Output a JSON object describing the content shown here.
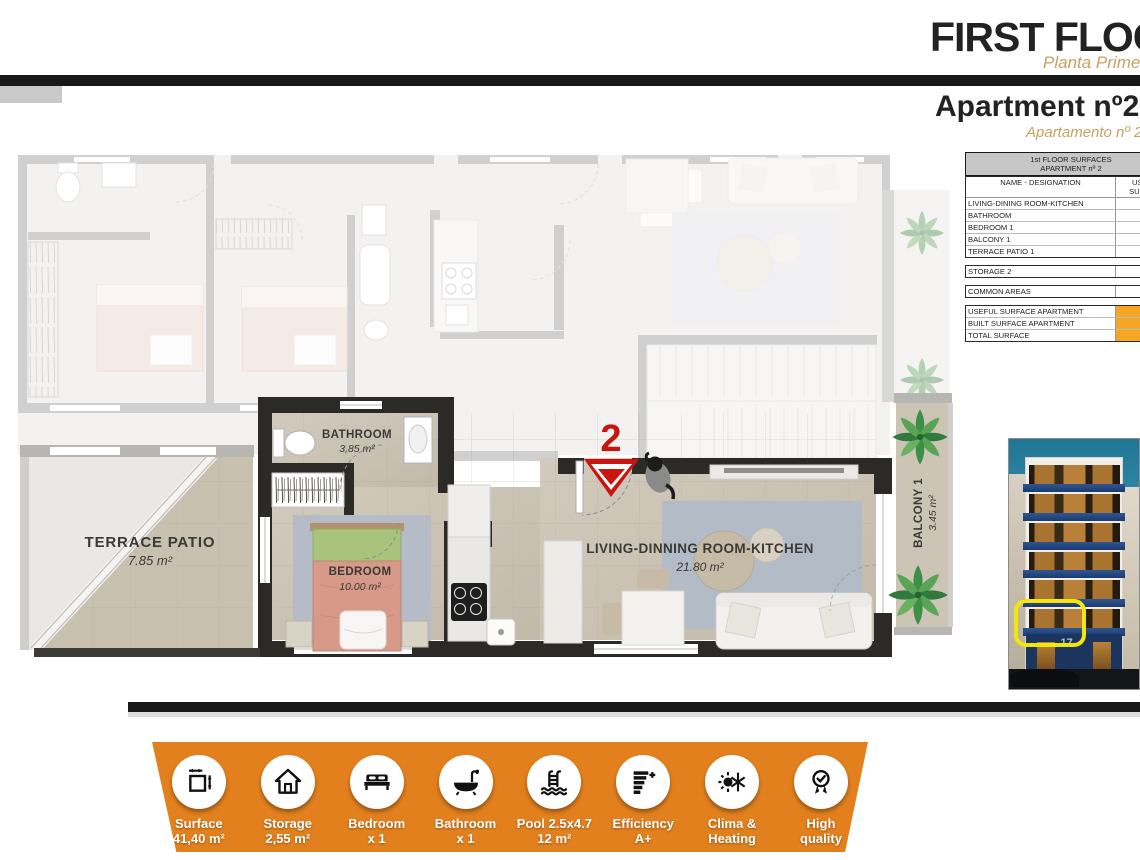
{
  "header": {
    "title": "FIRST FLOOR",
    "subtitle": "Planta Primera",
    "apartment_title": "Apartment nº2",
    "apartment_subtitle": "Apartamento nº 2"
  },
  "surfaces_table": {
    "title_line1": "1st FLOOR SURFACES",
    "title_line2": "APARTMENT nº 2",
    "col_name": "NAME - DESIGNATION",
    "col_value": "USEFUL SURFACE",
    "rooms": [
      {
        "name": "LIVING-DINING ROOM-KITCHEN",
        "value": "21.79 m²"
      },
      {
        "name": "BATHROOM",
        "value": "3.86 m²"
      },
      {
        "name": "BEDROOM 1",
        "value": "9.61 m²"
      },
      {
        "name": "BALCONY 1",
        "value": "3.45 m²"
      },
      {
        "name": "TERRACE PATIO 1",
        "value": "7.82 m²"
      }
    ],
    "storage": {
      "name": "STORAGE 2",
      "value": "2.55 m²"
    },
    "common_areas": {
      "name": "COMMON AREAS",
      "value": "6.95 m²"
    },
    "totals": [
      {
        "name": "USEFUL SURFACE APARTMENT",
        "value": "35.26 m²"
      },
      {
        "name": "BUILT SURFACE APARTMENT",
        "value": "41.37 m²"
      },
      {
        "name": "TOTAL SURFACE",
        "value": "62.14 m²"
      }
    ]
  },
  "floor_plan": {
    "entrance_number": "2",
    "rooms": {
      "terrace": {
        "name": "TERRACE  PATIO",
        "area": "7.85 m²"
      },
      "bathroom": {
        "name": "BATHROOM",
        "area": "3,85 m²"
      },
      "bedroom": {
        "name": "BEDROOM",
        "area": "10.00 m²"
      },
      "living": {
        "name": "LIVING-DINNING ROOM-KITCHEN",
        "area": "21.80 m²"
      },
      "balcony": {
        "name": "BALCONY 1",
        "area": "3.45 m²"
      }
    }
  },
  "building_photo": {
    "street_number": "17"
  },
  "footer": {
    "items": [
      {
        "icon": "surface-icon",
        "line1": "Surface",
        "line2": "41,40 m²"
      },
      {
        "icon": "storage-icon",
        "line1": "Storage",
        "line2": "2,55 m²"
      },
      {
        "icon": "bed-icon",
        "line1": "Bedroom",
        "line2": "x 1"
      },
      {
        "icon": "bath-icon",
        "line1": "Bathroom",
        "line2": "x 1"
      },
      {
        "icon": "pool-icon",
        "line1": "Pool 2.5x4.7",
        "line2": "12 m²"
      },
      {
        "icon": "efficiency-icon",
        "line1": "Efficiency",
        "line2": "A+"
      },
      {
        "icon": "clima-icon",
        "line1": "Clima &",
        "line2": "Heating"
      },
      {
        "icon": "quality-icon",
        "line1": "High",
        "line2": "quality"
      }
    ]
  },
  "colors": {
    "accent_orange": "#E2801D",
    "table_highlight_orange": "#F5A623",
    "title_tan": "#C9A063",
    "entrance_red": "#C9150F",
    "highlight_yellow": "#F2E60C"
  }
}
